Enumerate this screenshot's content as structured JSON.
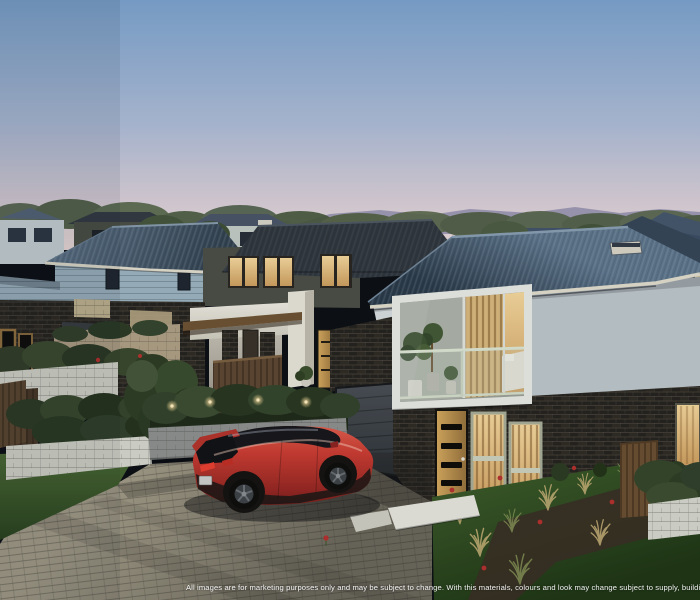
{
  "meta": {
    "type": "architectural-marketing-render",
    "description": "Dusk 3D render of a modern two-storey townhouse development: dark brick ground floors, white rendered upper floors, dark blue-grey hip roofs, warm lit windows, landscaped hedges and retaining walls, with a red compact SUV parked on a paved driveway",
    "time_of_day": "dusk",
    "width": 700,
    "height": 600
  },
  "disclaimer": {
    "text": "All images are for marketing purposes only and may be subject to change. With this materials, colours and look may change subject to supply, building co"
  },
  "scene": {
    "elements": [
      "dusk-sky",
      "mountain-range",
      "tree-line",
      "background-houses",
      "left-townhouse",
      "middle-townhouse",
      "right-townhouse",
      "balcony-window",
      "bedroom-interior",
      "balcony-plants",
      "garage-door",
      "front-door",
      "slat-windows",
      "timber-gate",
      "hedges",
      "retaining-walls",
      "timber-fence",
      "garden-uplights",
      "paver-driveway",
      "entry-path",
      "lawn",
      "garden-bed",
      "ornamental-grasses",
      "red-flowers",
      "red-suv"
    ]
  },
  "colors": {
    "sky_top": "#7ca2cd",
    "sky_mid": "#aebcd6",
    "sky_horizon": "#eedcda",
    "mountains": "#958fae",
    "trees": "#4e5c41",
    "bg_house_wall": "#a7bdc8",
    "olive_wall": "#4b4e44",
    "cream_wall": "#c9bc9b",
    "roof_dark": "#31414f",
    "roof_sheen": "#5f7489",
    "fascia": "#e2ddcd",
    "render_white": "#d8dddd",
    "render_shadow": "#bec6c9",
    "dark_brick": "#26221d",
    "cream_brick": "#c6b692",
    "timber": "#b3873f",
    "timber_fence": "#5d4730",
    "window_warm": "#f0c98a",
    "window_dark": "#20262e",
    "garage_door": "#43484d",
    "hedge": "#32422a",
    "block_wall_white": "#d6d6cb",
    "block_wall_grey": "#8e908e",
    "lawn": "#3f5c2a",
    "lawn_dark": "#243a16",
    "driveway": "#978f7b",
    "soil": "#3a2f22",
    "car_red": "#c9352e",
    "car_red_dark": "#8e221e",
    "car_glass": "#17161a",
    "flower_red": "#b5302c",
    "uplight": "#ffeec2",
    "text": "#ffffff"
  }
}
